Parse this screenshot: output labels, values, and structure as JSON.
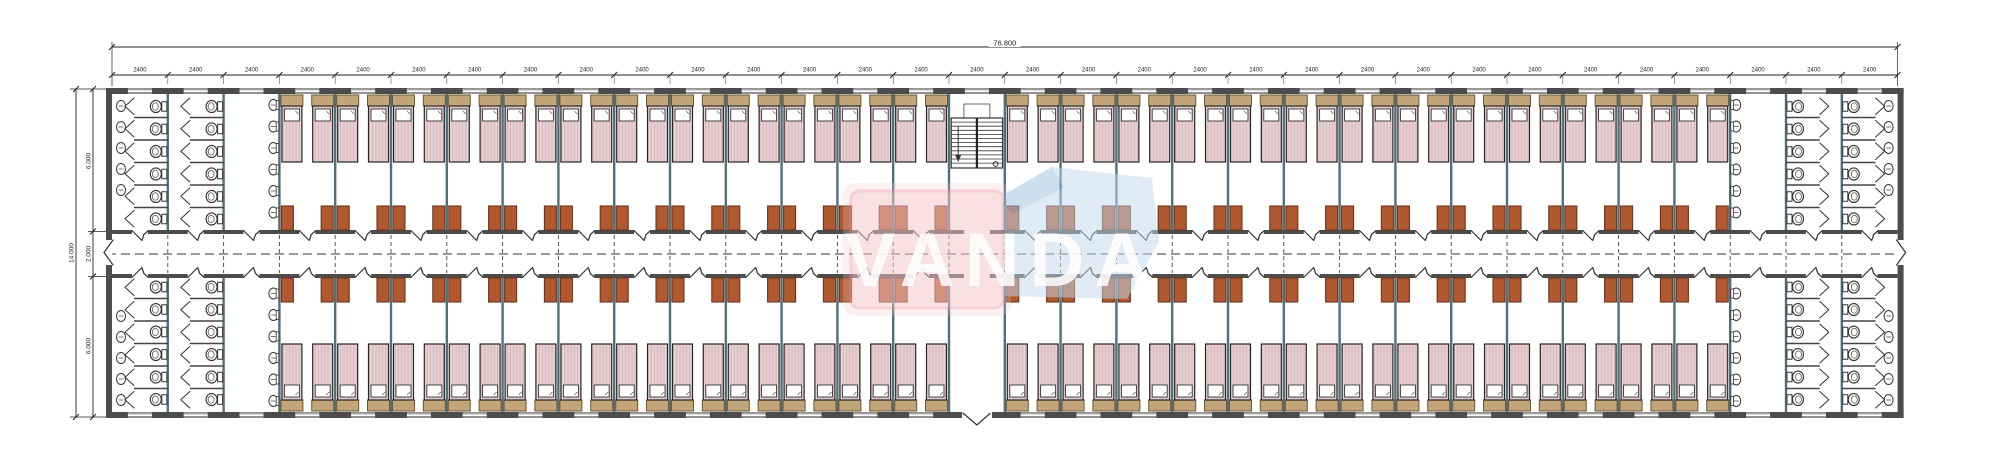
{
  "drawing": {
    "type": "architectural-floor-plan",
    "watermark": {
      "text": "VANDA",
      "pink": "#f3c5cb",
      "pink_border": "#eca9b3",
      "blue": "#c3d9ec",
      "blue_dark": "#9dc2e2",
      "text_color": "#ffffff"
    },
    "dimensions": {
      "total_width_label": "76.800",
      "bay_label": "2400",
      "bay_count": 32,
      "height_total_label": "14.000",
      "height_segment_labels": [
        "6.000",
        "2.000",
        "6.000"
      ]
    },
    "layout": {
      "sanitary_bays_left": [
        0,
        1,
        2
      ],
      "sanitary_bays_right": [
        29,
        30,
        31
      ],
      "stair_bay": 15,
      "rooms_per_row": 25,
      "beds_per_room": 2,
      "toilet_stalls_per_column": 6,
      "basins_per_column": 6,
      "wall_basins": 5
    },
    "colors": {
      "wall": "#4c4c4c",
      "partition": "#50707c",
      "line": "#333333",
      "dim": "#222222",
      "bed_fill": "#e9d2d4",
      "bed_stripe": "#d2b0b5",
      "bed_border": "#262626",
      "pillow": "#ffffff",
      "headboard": "#c2a578",
      "headboard_border": "#6d5936",
      "table_fill": "#b0582f",
      "table_border": "#6e3418",
      "window_line": "#6a6a6a"
    }
  }
}
